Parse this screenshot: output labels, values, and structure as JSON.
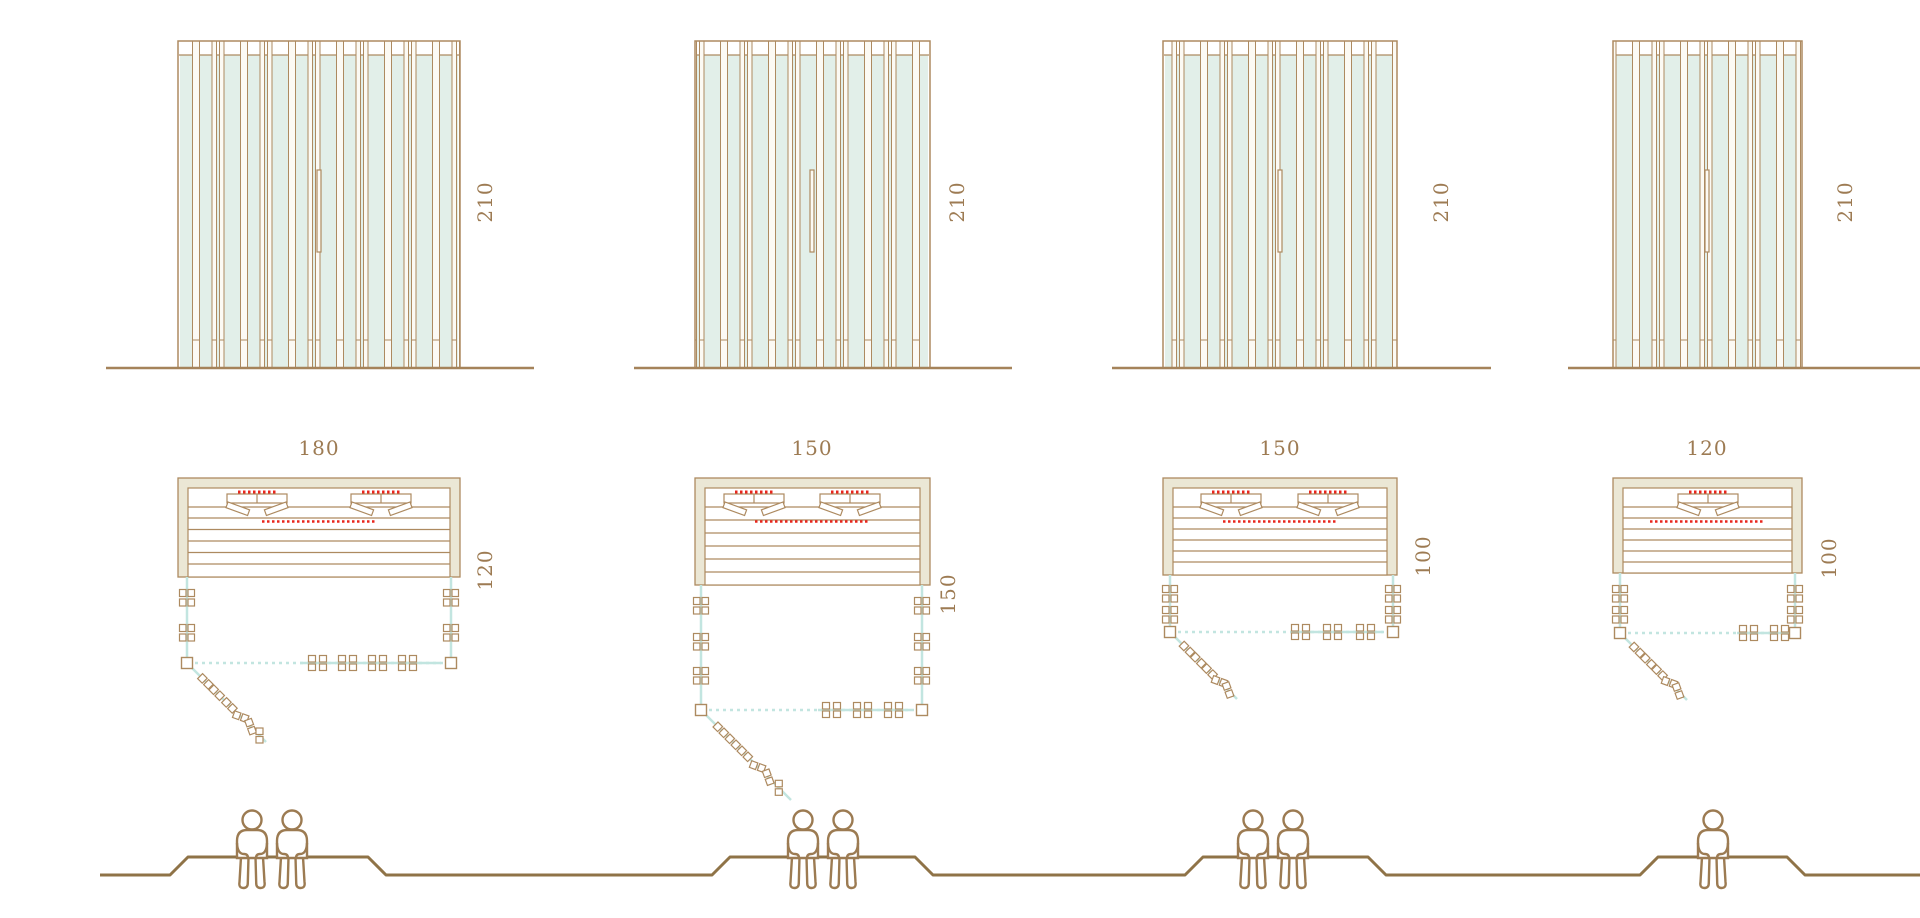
{
  "diagram": {
    "type": "sauna-cabin-size-comparison",
    "rows": [
      "front-elevations",
      "floor-plans",
      "bench-seating-capacity"
    ]
  },
  "colors": {
    "wood_line": "#ad8a60",
    "ground_line": "#a5835a",
    "bench_profile": "#8f7347",
    "beige_fill": "#ebe7d5",
    "glass_fill": "#e2efe9",
    "teal_line": "#c2e5e0",
    "heater_red": "#e8261d",
    "label_text": "#9d7b53",
    "background": "#ffffff"
  },
  "modules": [
    {
      "name": "sauna-180x120",
      "height_label": "210",
      "width_label": "180",
      "depth_label": "120",
      "seats": 2
    },
    {
      "name": "sauna-150x150",
      "height_label": "210",
      "width_label": "150",
      "depth_label": "150",
      "seats": 2
    },
    {
      "name": "sauna-150x100",
      "height_label": "210",
      "width_label": "150",
      "depth_label": "100",
      "seats": 2
    },
    {
      "name": "sauna-120x100",
      "height_label": "210",
      "width_label": "120",
      "depth_label": "100",
      "seats": 1
    }
  ]
}
